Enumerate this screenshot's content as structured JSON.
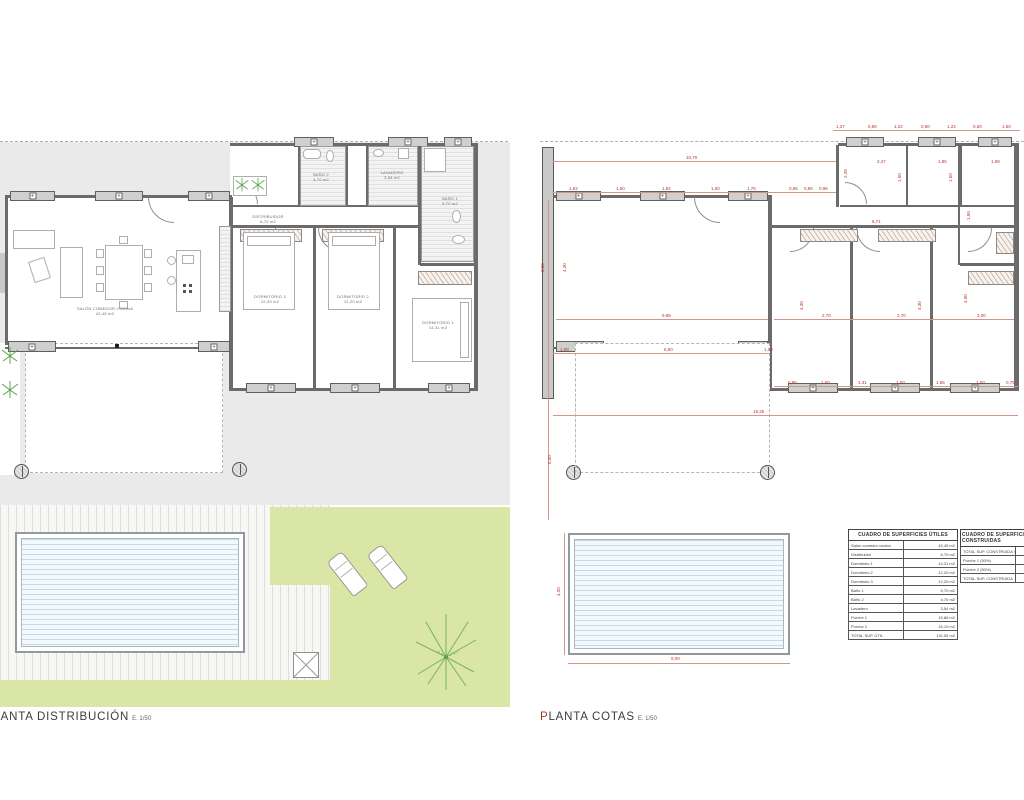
{
  "sheet": {
    "width": 1024,
    "height": 800,
    "background": "#ffffff"
  },
  "colors": {
    "plot_gray": "#eaeaea",
    "wall": "#6b6b6b",
    "window_pier": "#cfcfcf",
    "lawn_green": "#d9e6a5",
    "plant_green": "#5da14e",
    "pool_water": "#c6dbe6",
    "dimension_red": "#b5382a",
    "label_gray": "#6e6e6e"
  },
  "plans": {
    "distribucion": {
      "title": "PLANTA DISTRIBUCIÓN",
      "scale": "E. 1/50",
      "rooms": [
        {
          "name": "SALÓN COMEDOR COCINA",
          "area": "42,45 m2",
          "x": 105,
          "y": 306
        },
        {
          "name": "DISTRIBUIDOR",
          "area": "6,70 m2",
          "x": 268,
          "y": 214
        },
        {
          "name": "DORMITORIO 3",
          "area": "12,20 m2",
          "x": 270,
          "y": 294
        },
        {
          "name": "DORMITORIO 2",
          "area": "12,20 m2",
          "x": 353,
          "y": 294
        },
        {
          "name": "DORMITORIO 1",
          "area": "14,31 m2",
          "x": 438,
          "y": 320
        },
        {
          "name": "BAÑO 2",
          "area": "4,70 m2",
          "x": 321,
          "y": 172
        },
        {
          "name": "LAVADERO",
          "area": "3,54 m2",
          "x": 392,
          "y": 170
        },
        {
          "name": "BAÑO 1",
          "area": "5,70 m2",
          "x": 450,
          "y": 196
        }
      ]
    },
    "cotas": {
      "title": "PLANTA COTAS",
      "scale": "E. 1/50",
      "dimensions": [
        {
          "t": "1,27",
          "x": 836,
          "y": 124
        },
        {
          "t": "0,60",
          "x": 868,
          "y": 124
        },
        {
          "t": "1,22",
          "x": 894,
          "y": 124
        },
        {
          "t": "0,60",
          "x": 921,
          "y": 124
        },
        {
          "t": "1,22",
          "x": 947,
          "y": 124
        },
        {
          "t": "0,60",
          "x": 973,
          "y": 124
        },
        {
          "t": "1,60",
          "x": 1002,
          "y": 124
        },
        {
          "t": "10,70",
          "x": 686,
          "y": 155
        },
        {
          "t": "2,47",
          "x": 877,
          "y": 159
        },
        {
          "t": "1,85",
          "x": 938,
          "y": 159
        },
        {
          "t": "1,99",
          "x": 991,
          "y": 159
        },
        {
          "t": "1,92",
          "x": 569,
          "y": 186
        },
        {
          "t": "1,50",
          "x": 616,
          "y": 186
        },
        {
          "t": "1,92",
          "x": 662,
          "y": 186
        },
        {
          "t": "1,00",
          "x": 711,
          "y": 186
        },
        {
          "t": "1,70",
          "x": 747,
          "y": 186
        },
        {
          "t": "0,96",
          "x": 789,
          "y": 186
        },
        {
          "t": "0,96",
          "x": 804,
          "y": 186
        },
        {
          "t": "0,96",
          "x": 819,
          "y": 186
        },
        {
          "t": "2,28",
          "x": 843,
          "y": 178,
          "rot": 1
        },
        {
          "t": "1,50",
          "x": 897,
          "y": 182,
          "rot": 1
        },
        {
          "t": "1,50",
          "x": 948,
          "y": 182,
          "rot": 1
        },
        {
          "t": "6,71",
          "x": 872,
          "y": 219
        },
        {
          "t": "1,50",
          "x": 966,
          "y": 220,
          "rot": 1
        },
        {
          "t": "3,08",
          "x": 540,
          "y": 272,
          "rot": 1
        },
        {
          "t": "4,40",
          "x": 562,
          "y": 272,
          "rot": 1
        },
        {
          "t": "9,85",
          "x": 662,
          "y": 313
        },
        {
          "t": "2,70",
          "x": 822,
          "y": 313
        },
        {
          "t": "2,70",
          "x": 897,
          "y": 313
        },
        {
          "t": "3,00",
          "x": 977,
          "y": 313
        },
        {
          "t": "4,30",
          "x": 799,
          "y": 310,
          "rot": 1
        },
        {
          "t": "4,30",
          "x": 917,
          "y": 310,
          "rot": 1
        },
        {
          "t": "4,90",
          "x": 963,
          "y": 303,
          "rot": 1
        },
        {
          "t": "1,08",
          "x": 560,
          "y": 347
        },
        {
          "t": "6,90",
          "x": 664,
          "y": 347
        },
        {
          "t": "1,00",
          "x": 764,
          "y": 347
        },
        {
          "t": "0,95",
          "x": 788,
          "y": 380
        },
        {
          "t": "1,50",
          "x": 821,
          "y": 380
        },
        {
          "t": "1,31",
          "x": 858,
          "y": 380
        },
        {
          "t": "1,50",
          "x": 896,
          "y": 380
        },
        {
          "t": "1,65",
          "x": 936,
          "y": 380
        },
        {
          "t": "1,50",
          "x": 976,
          "y": 380
        },
        {
          "t": "0,75",
          "x": 1006,
          "y": 380
        },
        {
          "t": "19,25",
          "x": 753,
          "y": 409
        },
        {
          "t": "5,00",
          "x": 547,
          "y": 464,
          "rot": 1
        },
        {
          "t": "4,20",
          "x": 556,
          "y": 596,
          "rot": 1
        },
        {
          "t": "9,00",
          "x": 671,
          "y": 656
        }
      ]
    }
  },
  "tables": {
    "utiles": {
      "title": "CUADRO DE SUPERFICIES ÚTILES",
      "rows": [
        {
          "label": "Salón comedor cocina",
          "value": "42,45 m2"
        },
        {
          "label": "Distribuidor",
          "value": "6,70 m2"
        },
        {
          "label": "Dormitorio 1",
          "value": "14,31 m2"
        },
        {
          "label": "Dormitorio 2",
          "value": "12,20 m2"
        },
        {
          "label": "Dormitorio 3",
          "value": "12,20 m2"
        },
        {
          "label": "Baño 1",
          "value": "5,70 m2"
        },
        {
          "label": "Baño 2",
          "value": "4,70 m2"
        },
        {
          "label": "Lavadero",
          "value": "3,54 m2"
        },
        {
          "label": "Porche 1",
          "value": "19,86 m2"
        },
        {
          "label": "Porche 2",
          "value": "16,10 m2"
        },
        {
          "label": "TOTAL SUP. ÚTIL",
          "value": "132,05 m2"
        }
      ]
    },
    "construidas": {
      "title": "CUADRO DE SUPERFICIES CONSTRUIDAS",
      "rows": [
        {
          "label": "TOTAL SUP. CONSTRUIDA VIVIENDA",
          "value": ""
        },
        {
          "label": "Porche 1 (50%)",
          "value": ""
        },
        {
          "label": "Porche 2 (50%)",
          "value": ""
        },
        {
          "label": "TOTAL SUP. CONSTRUIDA",
          "value": ""
        }
      ]
    }
  }
}
